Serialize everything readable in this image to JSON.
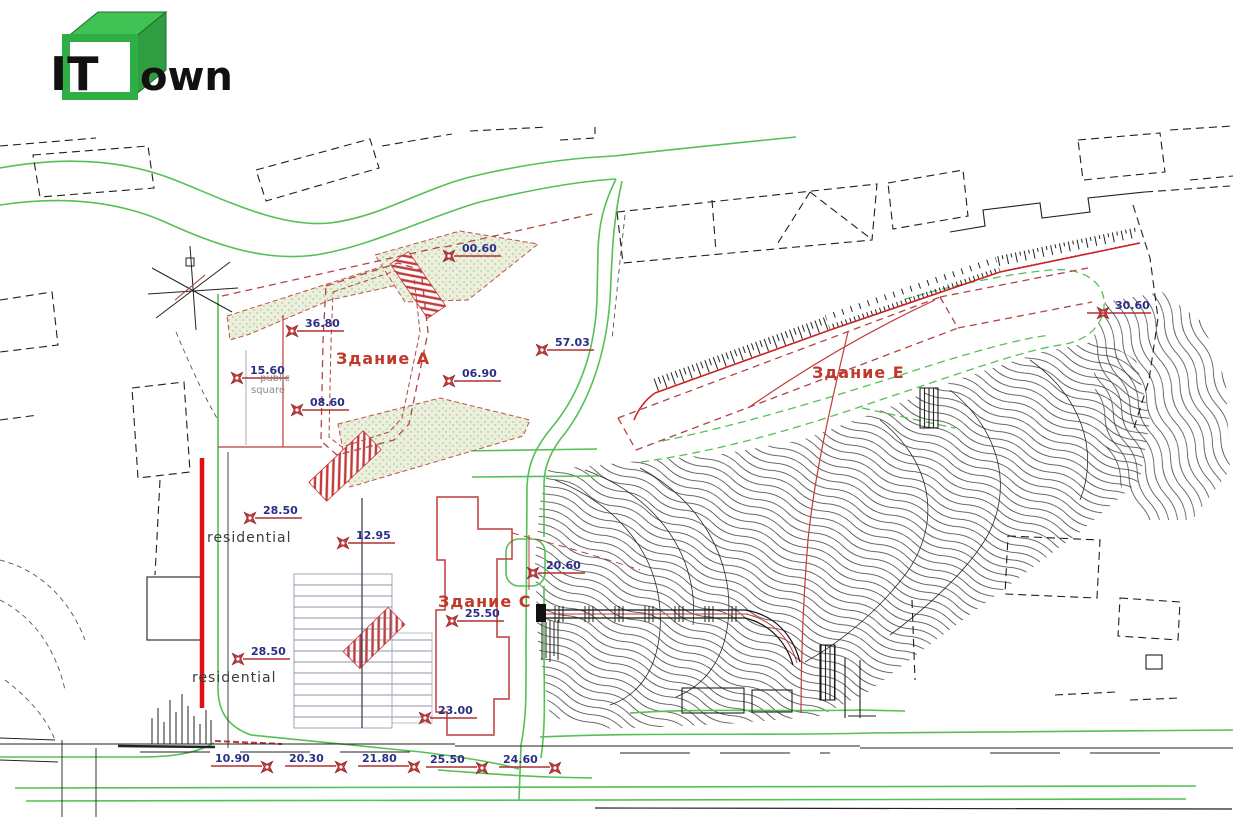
{
  "logo": {
    "it": "IT",
    "rest": "own"
  },
  "labels": {
    "building_a": "Здание А",
    "building_e": "Здание Е",
    "building_c": "Здание С",
    "public_1": "public",
    "public_2": "square",
    "residential_1": "residential",
    "residential_2": "residential"
  },
  "markers": [
    {
      "label": "36.80"
    },
    {
      "label": "00.60"
    },
    {
      "label": "57.03"
    },
    {
      "label": "15.60"
    },
    {
      "label": "08.60"
    },
    {
      "label": "06.90"
    },
    {
      "label": "28.50"
    },
    {
      "label": "12.95"
    },
    {
      "label": "20.60"
    },
    {
      "label": "25.50"
    },
    {
      "label": "28.50"
    },
    {
      "label": "23.00"
    },
    {
      "label": "10.90"
    },
    {
      "label": "20.30"
    },
    {
      "label": "21.80"
    },
    {
      "label": "25.50"
    },
    {
      "label": "24.60"
    },
    {
      "label": "30.60"
    }
  ],
  "colors": {
    "logo_green": "#35b24a",
    "road_green": "#55c055",
    "outline_red": "#c23b3b",
    "thick_red_wall": "#e01010",
    "marker_text_blue": "#2a2f86",
    "label_red": "#c0392b",
    "drawing_black": "#1f1f1f"
  }
}
